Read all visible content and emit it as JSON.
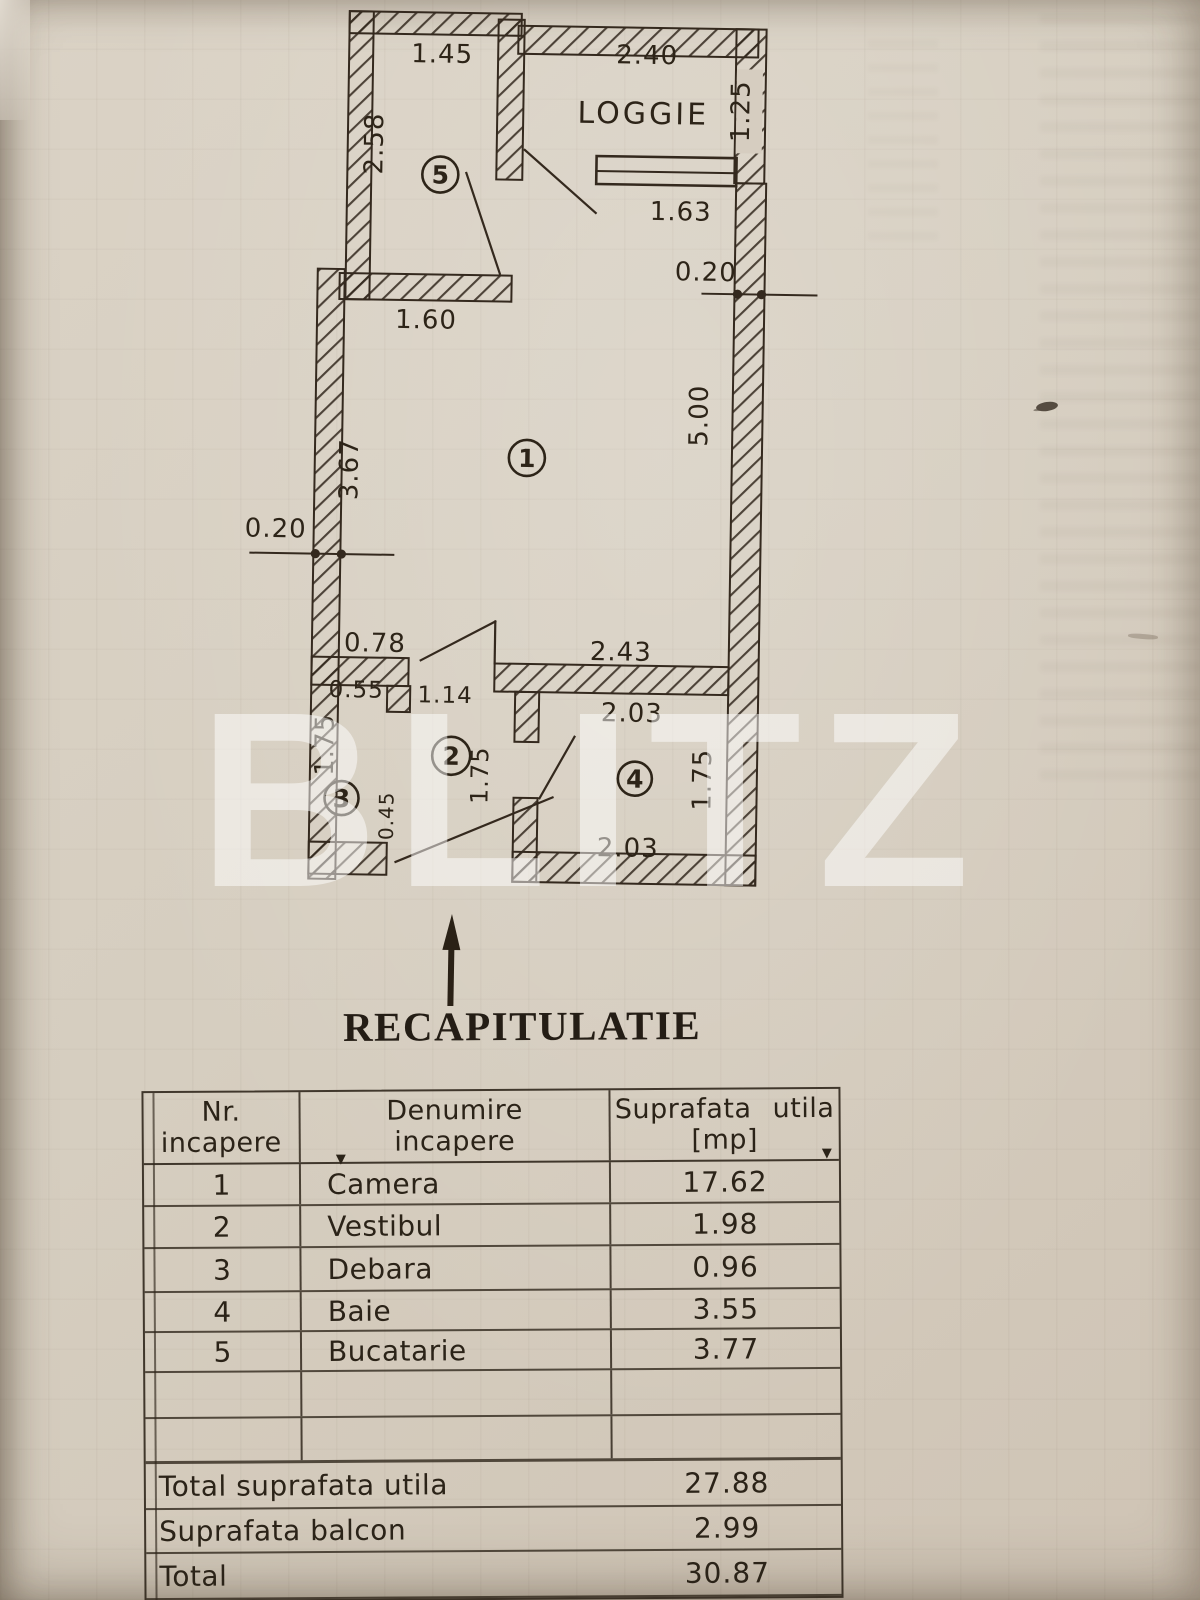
{
  "watermark": "BLITZ",
  "title": "RECAPITULATIE",
  "plan": {
    "loggia_label": "LOGGIE",
    "rooms": {
      "r1": "1",
      "r2": "2",
      "r3": "3",
      "r4": "4",
      "r5": "5"
    },
    "dims": {
      "d145": "1.45",
      "d240": "2.40",
      "d125": "1.25",
      "d258": "2.58",
      "d163": "1.63",
      "d020r": "0.20",
      "d160": "1.60",
      "d367": "3.67",
      "d500": "5.00",
      "d020l": "0.20",
      "d078": "0.78",
      "d243": "2.43",
      "d055": "0.55",
      "d114": "1.14",
      "d203t": "2.03",
      "d203b": "2.03",
      "d175a": "1.75",
      "d175b": "1.75",
      "d175c": "1.75",
      "d045": "0.45"
    }
  },
  "table": {
    "header": {
      "c1a": "Nr.",
      "c1b": "incapere",
      "c2a": "Denumire",
      "c2b": "incapere",
      "c3a": "Suprafata utila",
      "c3b": "[mp]"
    },
    "rows": [
      {
        "nr": "1",
        "name": "Camera",
        "area": "17.62"
      },
      {
        "nr": "2",
        "name": "Vestibul",
        "area": "1.98"
      },
      {
        "nr": "3",
        "name": "Debara",
        "area": "0.96"
      },
      {
        "nr": "4",
        "name": "Baie",
        "area": "3.55"
      },
      {
        "nr": "5",
        "name": "Bucatarie",
        "area": "3.77"
      }
    ],
    "totals": [
      {
        "label": "Total suprafata utila",
        "value": "27.88"
      },
      {
        "label": "Suprafata balcon",
        "value": "2.99"
      },
      {
        "label": "Total",
        "value": "30.87"
      }
    ]
  }
}
